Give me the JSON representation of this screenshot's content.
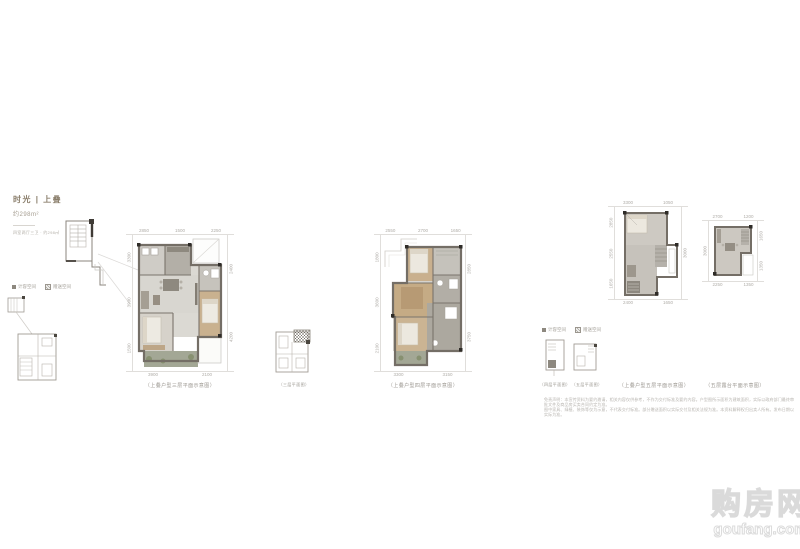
{
  "header": {
    "title": "时光 | 上叠",
    "area": "约298m²",
    "note": "四室两厅三卫 · 约298㎡"
  },
  "legend": {
    "items": [
      {
        "label": "计容空间"
      },
      {
        "label": "赠送空间"
      }
    ]
  },
  "plans": {
    "plan1": {
      "caption": "（上叠户型三层平面示意图）",
      "dims_top": [
        "2850",
        "1500",
        "2250"
      ],
      "dims_bottom": [
        "3900",
        "2100"
      ],
      "dims_left": [
        "3300",
        "3900",
        "1500"
      ],
      "dims_right": [
        "2400",
        "4200"
      ]
    },
    "plan2": {
      "caption": "（上叠户型四层平面示意图）",
      "dims_top": [
        "2550",
        "2700",
        "1650"
      ],
      "dims_bottom": [
        "3300",
        "3150"
      ],
      "dims_left": [
        "1800",
        "3600",
        "2100"
      ],
      "dims_right": [
        "2850",
        "3750"
      ]
    },
    "plan3a": {
      "caption": "（上叠户型五层平面示意图）",
      "dims_top": [
        "3300",
        "1050"
      ],
      "dims_bottom": [
        "2400",
        "1650"
      ],
      "dims_left": [
        "2850",
        "2550",
        "1650"
      ],
      "dims_right": [
        "3000"
      ]
    },
    "plan3b": {
      "caption": "（五层露台平面示意图）",
      "dims_top": [
        "2700",
        "1200"
      ],
      "dims_bottom": [
        "2250",
        "1350"
      ],
      "dims_left": [
        "3000"
      ],
      "dims_right": [
        "1650",
        "1350"
      ]
    }
  },
  "insets": {
    "inset_b_caption": "（三层平面图）",
    "inset_c_caption": "（四层平面图）",
    "inset_d_caption": "（五层平面图）"
  },
  "disclaimer": {
    "line1": "免责声明：本宣传资料为要约邀请，相关内容仅供参考，不作为交付标准及要约内容。户型图所示面积为建筑面积，实际以政府部门最终审批文件及商品房买卖合同约定为准。",
    "line2": "图中家具、绿植、装饰等仅为示意，不代表交付标准。部分赠送面积以实际交付及相关法规为准。本资料解释权归出卖人所有。发布日期以实际为准。"
  },
  "watermark": {
    "cn": "购房网",
    "en": "goufang.com"
  },
  "colors": {
    "wall": "#746e66",
    "floor_gray": "#d8d6d0",
    "floor_wood": "#c9b08e",
    "balcony_green": "#a3a795",
    "dim_text": "#b0ada8",
    "title_gold": "#8a7e6b"
  }
}
